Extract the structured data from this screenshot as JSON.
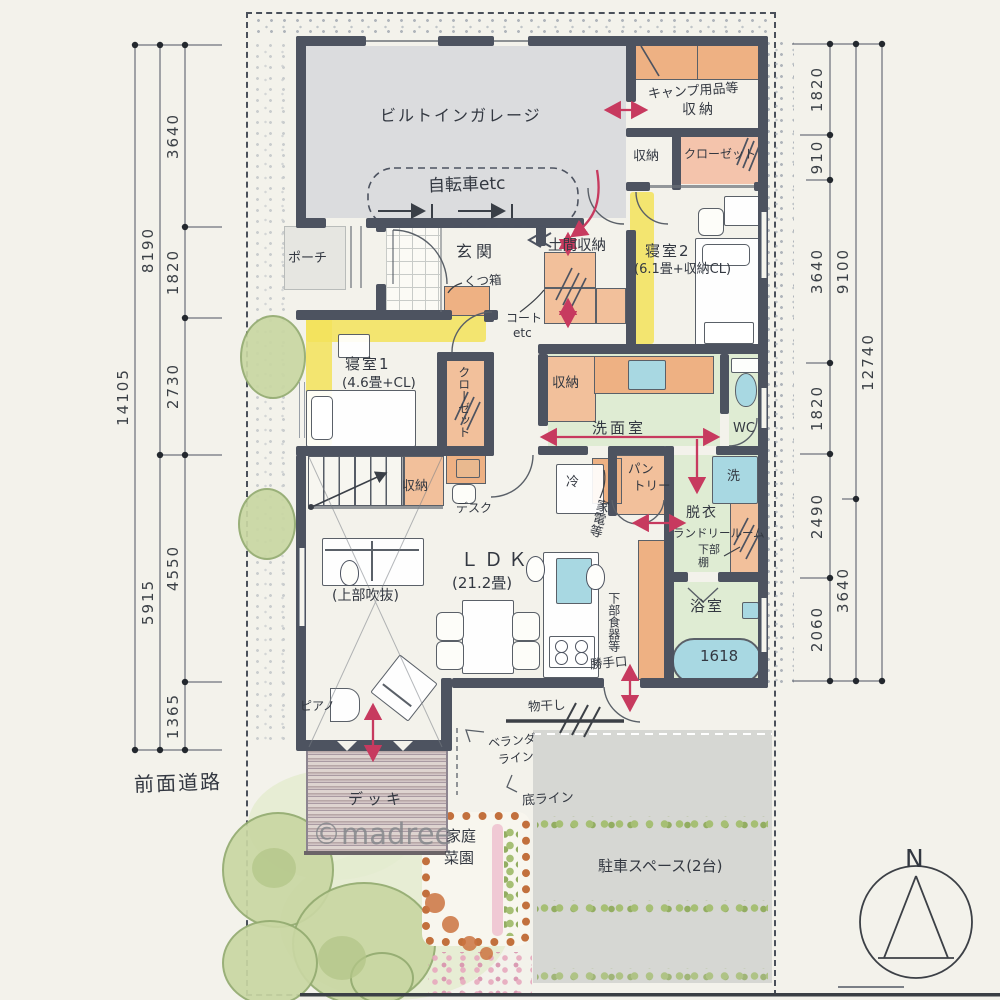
{
  "site": {
    "front_road": "前面道路",
    "compass_n": "N",
    "watermark": "©madree"
  },
  "dims_left": {
    "outer": "14105",
    "mid": [
      "8190",
      "5915"
    ],
    "inner": [
      "3640",
      "1820",
      "2730",
      "4550",
      "1365"
    ]
  },
  "dims_right": {
    "outer": "12740",
    "mid": [
      "9100",
      "3640"
    ],
    "inner": [
      "1820",
      "910",
      "3640",
      "1820",
      "2490",
      "2060"
    ]
  },
  "rooms": {
    "garage": "ビルトインガレージ",
    "bicycle": "自転車etc",
    "camp_line1": "キャンプ用品等",
    "camp_line2": "収納",
    "storage_top": "収納",
    "closet_top": "クローゼット",
    "bedroom2_line1": "寝室2",
    "bedroom2_line2": "(6.1畳+収納CL)",
    "porch": "ポーチ",
    "entrance": "玄関",
    "shoe_box": "くつ箱",
    "doma_storage": "土間収納",
    "coat_line1": "コート",
    "coat_line2": "etc",
    "bedroom1_line1": "寝室1",
    "bedroom1_line2": "(4.6畳+CL)",
    "closet1": "クローゼット",
    "stair_storage": "収納",
    "desk": "デスク",
    "wash_storage": "収納",
    "washroom": "洗面室",
    "wc": "WC",
    "fridge": "冷",
    "pantry_line1": "パン",
    "pantry_line2": "トリー",
    "appliance": "家電等",
    "undress_line1": "脱衣",
    "undress_line2": "ランドリールーム",
    "undress_line3": "下部棚",
    "washer": "洗",
    "bath": "浴室",
    "tub": "1618",
    "ldk_line1": "ＬＤＫ",
    "ldk_line2": "(21.2畳)",
    "void": "(上部吹抜)",
    "piano": "ピアノ",
    "dish_lower": "下部食器等",
    "side_door": "勝手口",
    "drying": "物干し",
    "deck": "デッキ",
    "veranda_line1": "ベランダ",
    "veranda_line2": "ライン",
    "bottom_line": "底ライン",
    "garden_line1": "家庭",
    "garden_line2": "菜園",
    "parking": "駐車スペース(2台)"
  }
}
